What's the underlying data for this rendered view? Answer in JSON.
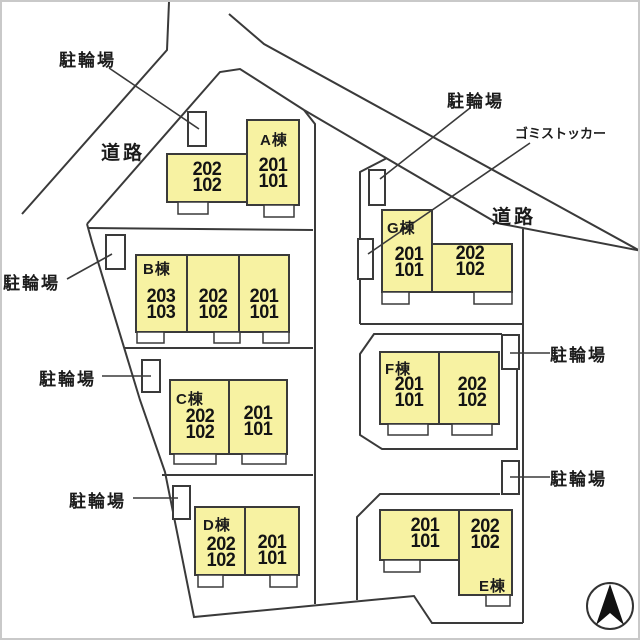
{
  "plan": {
    "annotations": {
      "bike_parking_labels": [
        "駐輪場",
        "駐輪場",
        "駐輪場",
        "駐輪場",
        "駐輪場",
        "駐輪場",
        "駐輪場"
      ],
      "road_labels": [
        "道路",
        "道路"
      ],
      "garbage_label": "ゴミストッカー"
    },
    "buildings": [
      {
        "name": "A棟",
        "sections": [
          {
            "units": "202\n102"
          },
          {
            "units": "201\n101"
          }
        ]
      },
      {
        "name": "B棟",
        "sections": [
          {
            "units": "203\n103"
          },
          {
            "units": "202\n102"
          },
          {
            "units": "201\n101"
          }
        ]
      },
      {
        "name": "C棟",
        "sections": [
          {
            "units": "202\n102"
          },
          {
            "units": "201\n101"
          }
        ]
      },
      {
        "name": "D棟",
        "sections": [
          {
            "units": "202\n102"
          },
          {
            "units": "201\n101"
          }
        ]
      },
      {
        "name": "E棟",
        "sections": [
          {
            "units": "201\n101"
          },
          {
            "units": "202\n102"
          }
        ]
      },
      {
        "name": "F棟",
        "sections": [
          {
            "units": "201\n101"
          },
          {
            "units": "202\n102"
          }
        ]
      },
      {
        "name": "G棟",
        "sections": [
          {
            "units": "201\n101"
          },
          {
            "units": "202\n102"
          }
        ]
      }
    ],
    "colors": {
      "building_fill": "#f7f2a2",
      "line": "#3a3a3a",
      "compass_fill": "#111111"
    }
  }
}
